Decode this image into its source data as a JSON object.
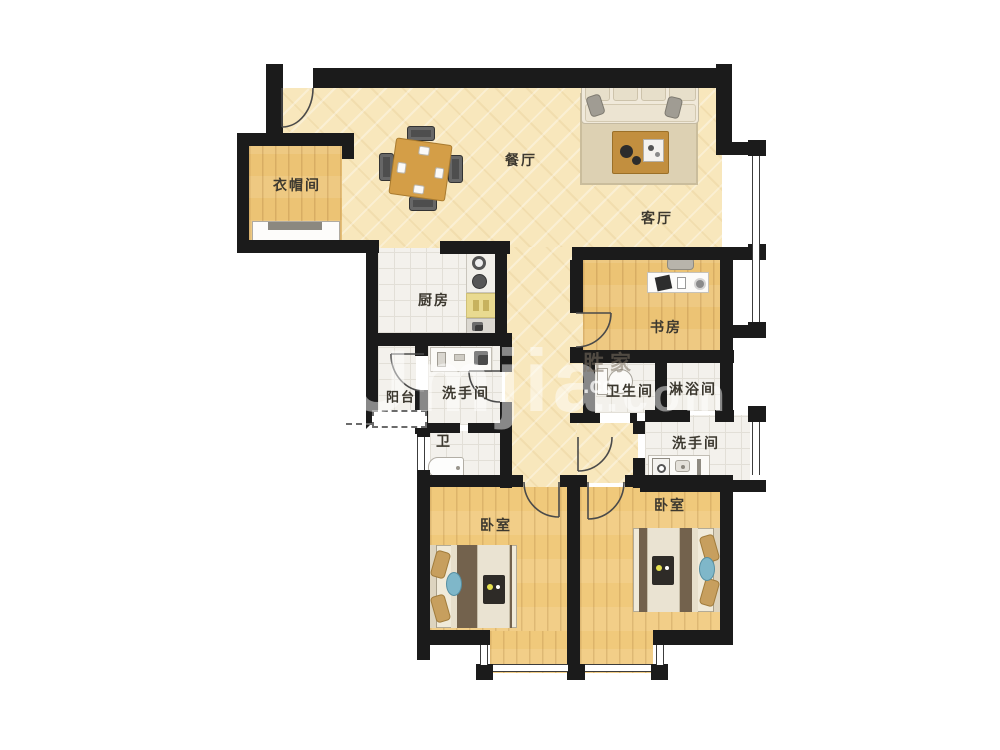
{
  "plan": {
    "type": "apartment-floor-plan",
    "colors": {
      "wall": "#1b1b1b",
      "floor_cream": "#f8e7bc",
      "floor_wood": "#ecc374",
      "floor_tile": "#f3f1ec",
      "bed_blanket": "#73624d",
      "pillow_tan": "#c79f5e",
      "cushion_blue": "#7fb7c9",
      "table_wood": "#d49e47",
      "label_text": "#3c382f"
    }
  },
  "rooms": {
    "cloakroom": {
      "label": "衣帽间"
    },
    "dining": {
      "label": "餐厅"
    },
    "living": {
      "label": "客厅"
    },
    "kitchen": {
      "label": "厨房"
    },
    "study": {
      "label": "书房"
    },
    "balcony": {
      "label": "阳台"
    },
    "washroom_mid": {
      "label": "洗手间"
    },
    "toilet_small": {
      "label": "卫"
    },
    "bathroom": {
      "label": "卫生间"
    },
    "shower": {
      "label": "淋浴间"
    },
    "washroom_right": {
      "label": "洗手间"
    },
    "bedroom_left": {
      "label": "卧室"
    },
    "bedroom_right": {
      "label": "卧室"
    }
  },
  "watermark": {
    "main": "Umjia",
    "main_suffix": ".com",
    "brand": "胜家",
    "brand_sub": ".co"
  }
}
